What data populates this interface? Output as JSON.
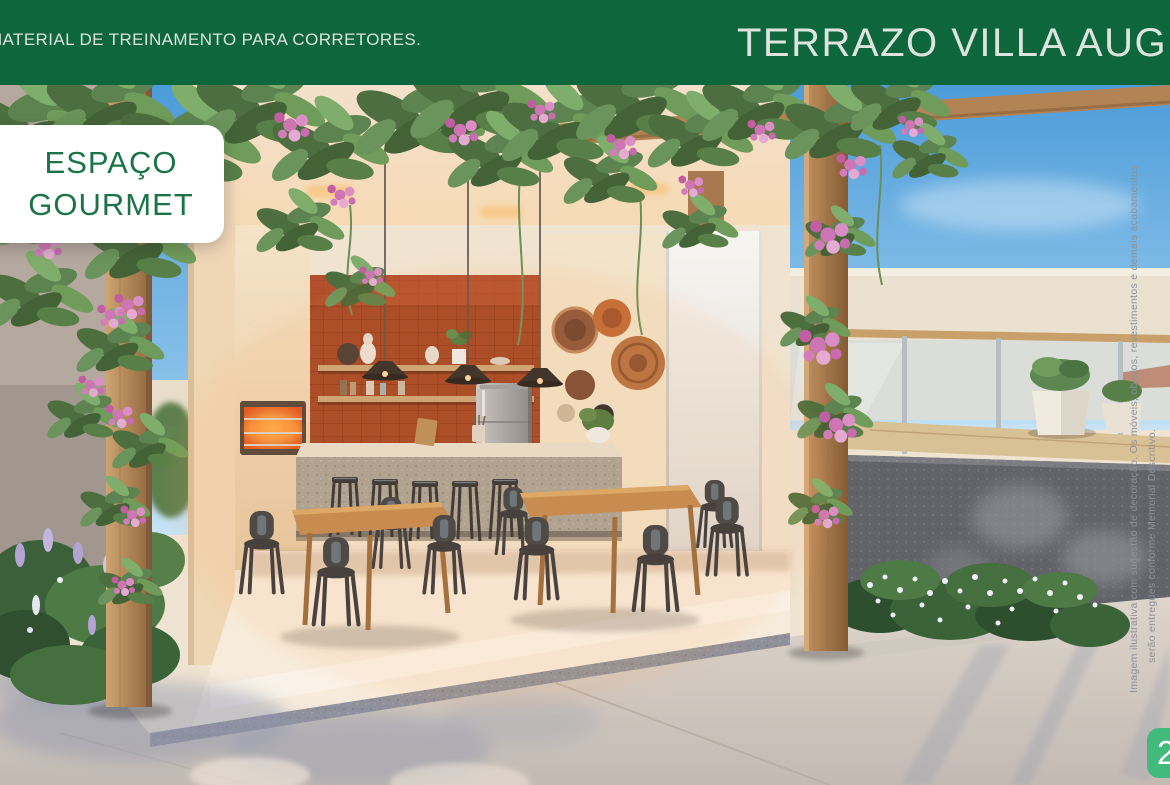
{
  "slide": {
    "header": {
      "training_label": "MATERIAL DE TREINAMENTO PARA CORRETORES.",
      "project_title": "TERRAZO VILLA AUGUSTA"
    },
    "feature_card": {
      "line1": "ESPAÇO",
      "line2": "GOURMET"
    },
    "disclaimer": {
      "line1": "Imagem ilustrativa com sugestão de decoração. Os móveis, objetos, revestimentos e demais acabamentos",
      "line2": "serão entregues conforme Memorial Descritivo."
    },
    "page_number": "2"
  },
  "theme": {
    "header-green": "#0d663c",
    "header-text": "#dde4dc",
    "card-bg": "#ffffff",
    "card-green": "#1b7448",
    "badge-green": "#42ba7c",
    "badge-text": "#ffffff",
    "disclaimer-gray": "#8d9298",
    "sky-blue": "#4c9cd9",
    "tile-red": "#a34524",
    "wood-brown": "#b28355"
  }
}
